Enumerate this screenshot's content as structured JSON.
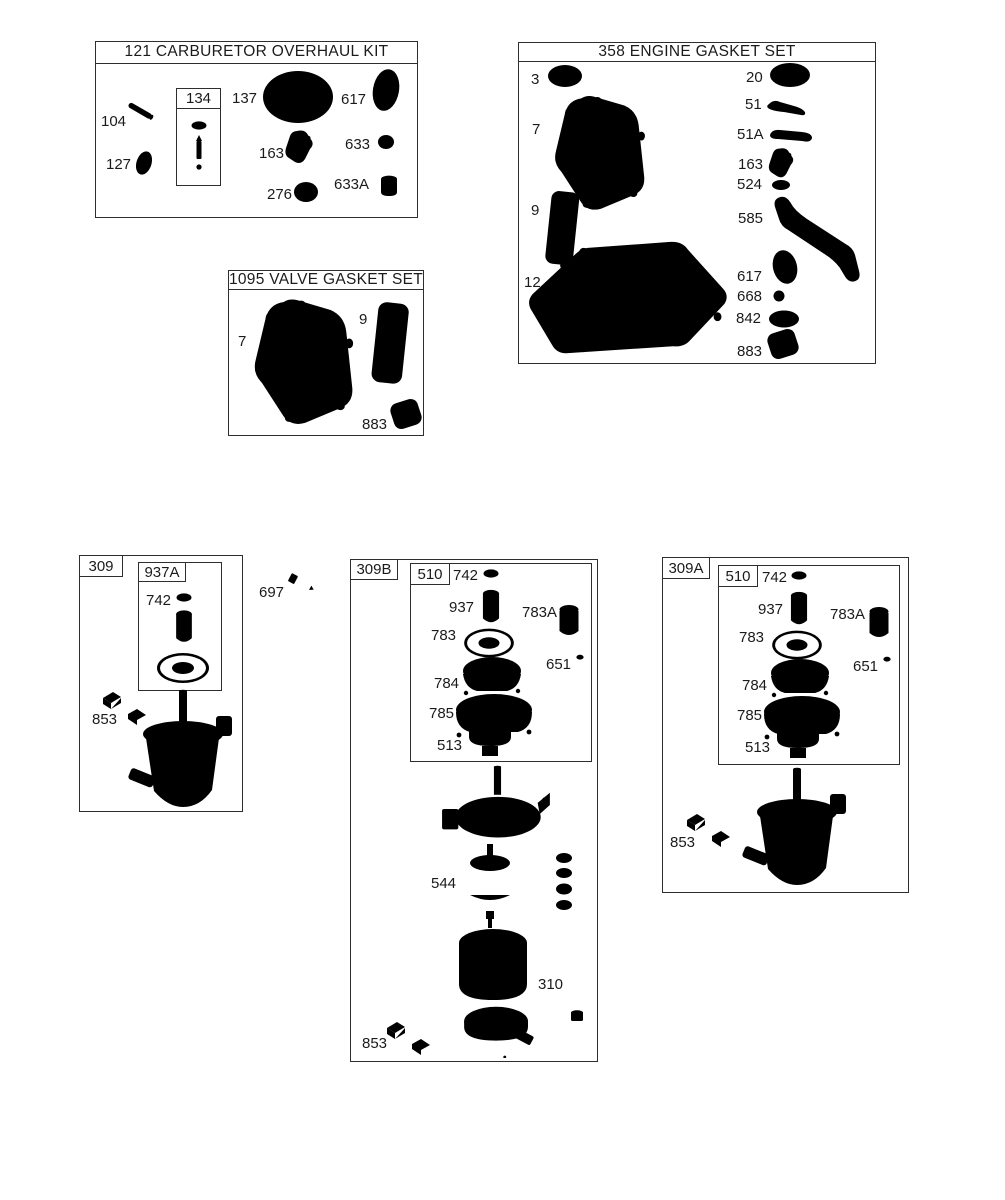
{
  "theme": {
    "ink": "#2e2e2e",
    "paper": "#ffffff"
  },
  "kits": {
    "carb": {
      "title": "121 CARBURETOR OVERHAUL KIT",
      "parts": {
        "p104": "104",
        "p127": "127",
        "p134": "134",
        "p137": "137",
        "p617": "617",
        "p163": "163",
        "p633": "633",
        "p276": "276",
        "p633a": "633A"
      }
    },
    "engine": {
      "title": "358 ENGINE GASKET SET",
      "parts": {
        "p3": "3",
        "p7": "7",
        "p9": "9",
        "p12": "12",
        "p20": "20",
        "p51": "51",
        "p51a": "51A",
        "p163": "163",
        "p524": "524",
        "p585": "585",
        "p617": "617",
        "p668": "668",
        "p842": "842",
        "p883": "883"
      }
    },
    "valve": {
      "title": "1095 VALVE GASKET SET",
      "parts": {
        "p7": "7",
        "p9": "9",
        "p883": "883"
      }
    }
  },
  "starters": {
    "s309": {
      "label": "309",
      "sub": "937A",
      "parts": {
        "p742": "742",
        "p853": "853"
      }
    },
    "s309b": {
      "label": "309B",
      "sub": "510",
      "parts": {
        "p742": "742",
        "p937": "937",
        "p783": "783",
        "p783a": "783A",
        "p651": "651",
        "p784": "784",
        "p785": "785",
        "p513": "513",
        "p544": "544",
        "p310": "310",
        "p853": "853"
      }
    },
    "s309a": {
      "label": "309A",
      "sub": "510",
      "parts": {
        "p742": "742",
        "p937": "937",
        "p783": "783",
        "p783a": "783A",
        "p651": "651",
        "p784": "784",
        "p785": "785",
        "p513": "513",
        "p853": "853"
      }
    },
    "p697": "697"
  }
}
